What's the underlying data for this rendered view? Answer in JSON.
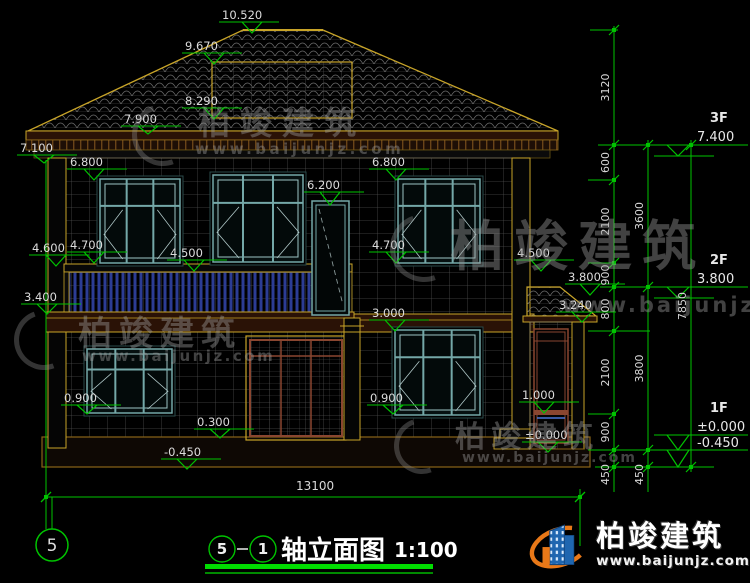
{
  "drawing_title": {
    "axis_from": "5",
    "axis_to": "1",
    "name": "轴立面图",
    "scale": "1:100"
  },
  "axis_bubble_label": "5",
  "overall_width_dim": "13100",
  "watermark": {
    "brand": "柏竣建筑",
    "url": "www.baijunjz.com"
  },
  "logo": {
    "brand": "柏竣建筑",
    "url": "www.baijunjz.com"
  },
  "floor_markers": [
    {
      "floor": "3F",
      "elev": "7.400",
      "ny": 122,
      "vy": 141,
      "ly": 145,
      "stub": 156
    },
    {
      "floor": "2F",
      "elev": "3.800",
      "ny": 264,
      "vy": 283,
      "ly": 287,
      "stub": 298
    },
    {
      "floor": "1F",
      "elev": "±0.000",
      "ny": 412,
      "vy": 431,
      "ly": 435,
      "stub": 450
    },
    {
      "floor": "",
      "elev": "-0.450",
      "ny": 0,
      "vy": 447,
      "ly": 450,
      "stub": 467
    }
  ],
  "elevation_markers": [
    {
      "label": "10.520",
      "x": 222,
      "ly": 22,
      "tx": 252,
      "ty": 33
    },
    {
      "label": "9.670",
      "x": 185,
      "ly": 53,
      "tx": 214,
      "ty": 64
    },
    {
      "label": "8.290",
      "x": 185,
      "ly": 108,
      "tx": 214,
      "ty": 119
    },
    {
      "label": "7.900",
      "x": 124,
      "ly": 126,
      "tx": 148,
      "ty": 134
    },
    {
      "label": "7.100",
      "x": 20,
      "ly": 155,
      "tx": 44,
      "ty": 163
    },
    {
      "label": "6.800",
      "x": 70,
      "ly": 169,
      "tx": 94,
      "ty": 180
    },
    {
      "label": "6.200",
      "x": 307,
      "ly": 192,
      "tx": 330,
      "ty": 205
    },
    {
      "label": "6.800",
      "x": 372,
      "ly": 169,
      "tx": 396,
      "ty": 180
    },
    {
      "label": "4.600",
      "x": 32,
      "ly": 255,
      "tx": 56,
      "ty": 266
    },
    {
      "label": "4.700",
      "x": 70,
      "ly": 252,
      "tx": 94,
      "ty": 263
    },
    {
      "label": "4.500",
      "x": 170,
      "ly": 260,
      "tx": 194,
      "ty": 271
    },
    {
      "label": "4.700",
      "x": 372,
      "ly": 252,
      "tx": 396,
      "ty": 263
    },
    {
      "label": "4.500",
      "x": 517,
      "ly": 260,
      "tx": 541,
      "ty": 271
    },
    {
      "label": "3.800",
      "x": 568,
      "ly": 284,
      "tx": 590,
      "ty": 295
    },
    {
      "label": "3.400",
      "x": 24,
      "ly": 304,
      "tx": 47,
      "ty": 314
    },
    {
      "label": "3.240",
      "x": 559,
      "ly": 312,
      "tx": 582,
      "ty": 322
    },
    {
      "label": "3.000",
      "x": 372,
      "ly": 320,
      "tx": 395,
      "ty": 331
    },
    {
      "label": "1.000",
      "x": 522,
      "ly": 402,
      "tx": 544,
      "ty": 413
    },
    {
      "label": "0.900",
      "x": 64,
      "ly": 405,
      "tx": 87,
      "ty": 414
    },
    {
      "label": "0.900",
      "x": 370,
      "ly": 405,
      "tx": 393,
      "ty": 414
    },
    {
      "label": "0.300",
      "x": 197,
      "ly": 429,
      "tx": 220,
      "ty": 438
    },
    {
      "label": "±0.000",
      "x": 525,
      "ly": 442,
      "tx": 548,
      "ty": 452
    },
    {
      "label": "-0.450",
      "x": 164,
      "ly": 459,
      "tx": 187,
      "ty": 469
    }
  ],
  "dim_chains": [
    {
      "x": 614,
      "y1": 26,
      "y2": 492,
      "segments": [
        {
          "label": "3120",
          "a": 30,
          "b": 145
        },
        {
          "label": "600",
          "a": 145,
          "b": 180
        },
        {
          "label": "2100",
          "a": 180,
          "b": 263
        },
        {
          "label": "900",
          "a": 263,
          "b": 287
        },
        {
          "label": "800",
          "a": 287,
          "b": 331
        },
        {
          "label": "2100",
          "a": 331,
          "b": 414
        },
        {
          "label": "900",
          "a": 414,
          "b": 450
        },
        {
          "label": "450",
          "a": 450,
          "b": 467,
          "off": 16
        }
      ]
    },
    {
      "x": 648,
      "y1": 140,
      "y2": 492,
      "segments": [
        {
          "label": "3600",
          "a": 145,
          "b": 287
        },
        {
          "label": "3800",
          "a": 287,
          "b": 450
        },
        {
          "label": "450",
          "a": 450,
          "b": 467,
          "off": 16
        }
      ]
    },
    {
      "x": 691,
      "y1": 140,
      "y2": 472,
      "segments": [
        {
          "label": "7850",
          "a": 145,
          "b": 467
        }
      ]
    }
  ],
  "colors": {
    "dim_green": "#00c300",
    "underline_green": "#00dd00",
    "outline_yellow": "#c8a428",
    "window_teal": "#74a8a8",
    "frame_maroon": "#8a4630",
    "logo_blue": "#1f66b0",
    "logo_orange": "#e87818"
  }
}
